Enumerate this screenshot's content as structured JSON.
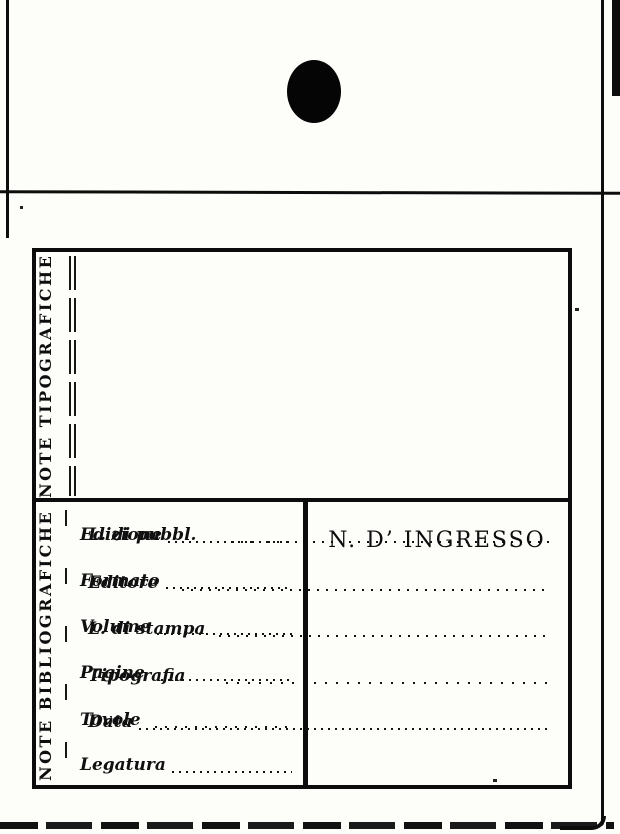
{
  "card": {
    "type_note": "library accession card (scanned)",
    "icons": {
      "punch_hole": "filled-black-oval"
    },
    "colors": {
      "ink": "#0d0d0d",
      "paper": "#fdfdfa"
    }
  },
  "form": {
    "note_tipografiche": {
      "section_label": "NOTE TIPOGRAFICHE",
      "fields": [
        {
          "label": "L. di pubbl.",
          "value": ""
        },
        {
          "label": "Editore",
          "value": ""
        },
        {
          "label": "L. di stampa",
          "value": ""
        },
        {
          "label": "Tipografia",
          "value": ""
        },
        {
          "label": "Data",
          "value": ""
        }
      ]
    },
    "note_bibliografiche": {
      "section_label": "NOTE BIBLIOGRAFICHE",
      "fields": [
        {
          "label": "Edizione",
          "value": ""
        },
        {
          "label": "Formato",
          "value": ""
        },
        {
          "label": "Volume",
          "value": ""
        },
        {
          "label": "Pagine",
          "value": ""
        },
        {
          "label": "Tavole",
          "value": ""
        },
        {
          "label": "Legatura",
          "value": ""
        }
      ]
    },
    "ingresso": {
      "label": "N. D’ INGRESSO"
    }
  }
}
